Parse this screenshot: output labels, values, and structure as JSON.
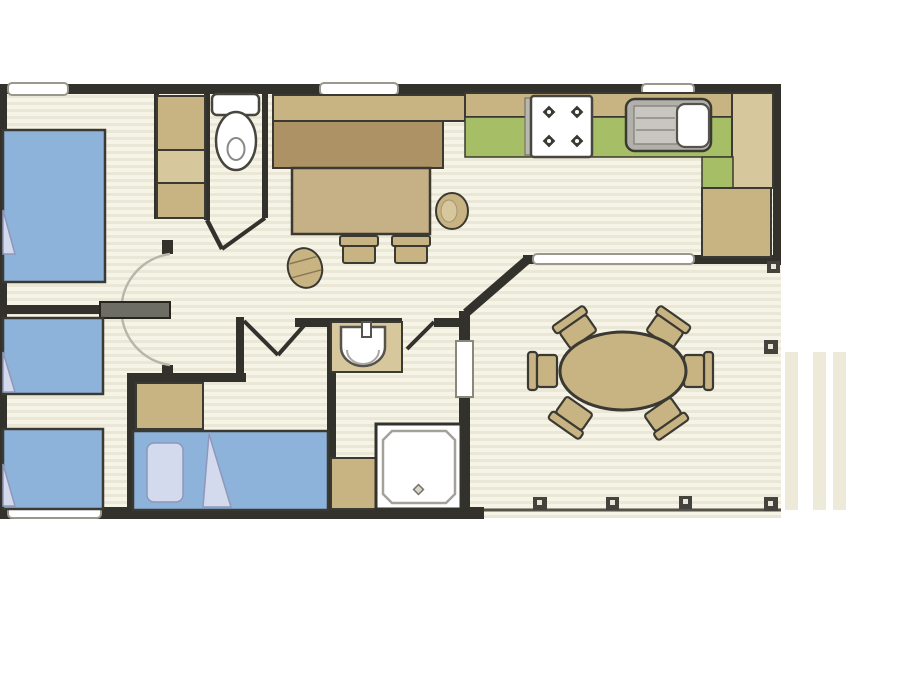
{
  "app": {
    "title": "Holiday mobile-home floor plan",
    "description": "Top-down 2D furnished floor plan, no text labels visible in the drawing"
  },
  "rooms": [
    {
      "name": "bedroom-main",
      "furniture": [
        "double-bed",
        "wardrobe-column-3-sections"
      ]
    },
    {
      "name": "bedroom-twin",
      "furniture": [
        "single-bed",
        "single-bed"
      ]
    },
    {
      "name": "bedroom-double",
      "furniture": [
        "double-bed-with-pillow-and-throw",
        "wardrobe"
      ]
    },
    {
      "name": "wc",
      "furniture": [
        "toilet-with-cistern"
      ]
    },
    {
      "name": "shower-room",
      "furniture": [
        "washbasin-with-tap",
        "shower-cubicle",
        "vanity-unit"
      ]
    },
    {
      "name": "hallway",
      "furniture": [
        "swing-door-with-arc"
      ]
    },
    {
      "name": "kitchen",
      "furniture": [
        "hob-4-burners",
        "sink-with-drainer",
        "worktop",
        "tall-unit",
        "corner-unit"
      ]
    },
    {
      "name": "living-dinette",
      "furniture": [
        "bench-seat",
        "table",
        "stool",
        "stool",
        "round-stool",
        "tub-armchair"
      ]
    },
    {
      "name": "covered-deck",
      "furniture": [
        "oval-dining-table",
        "six-chairs",
        "deck-posts",
        "side-steps"
      ]
    }
  ],
  "counts": {
    "windows": 5,
    "interior-doors": 5,
    "beds": 4,
    "hob-burners": 4,
    "dining-chairs": 6,
    "deck-posts": 6,
    "deck-steps": 3
  },
  "colors": {
    "wall": "#32312c",
    "outline": "#3a3932",
    "floor_light": "#f6f4e6",
    "floor_dark": "#eae7d7",
    "bed_blue": "#8db3da",
    "bedding": "#d3daee",
    "bedding_edge": "#8f97ba",
    "tan": "#c8b383",
    "tan_dark": "#ad9265",
    "tan_light": "#d7c79d",
    "tan_table": "#c6b085",
    "worktop_green": "#a6bf67",
    "fixture_gray": "#b2b0ab",
    "fixture_gray_light": "#c8c6c1",
    "door_gray": "#6e6d64",
    "arc_gray": "#b8b5a9",
    "white": "#ffffff",
    "window_stroke": "#9a978c",
    "post_fill": "#43423c",
    "post_center": "#e9e6d8",
    "step": "#edead9"
  }
}
